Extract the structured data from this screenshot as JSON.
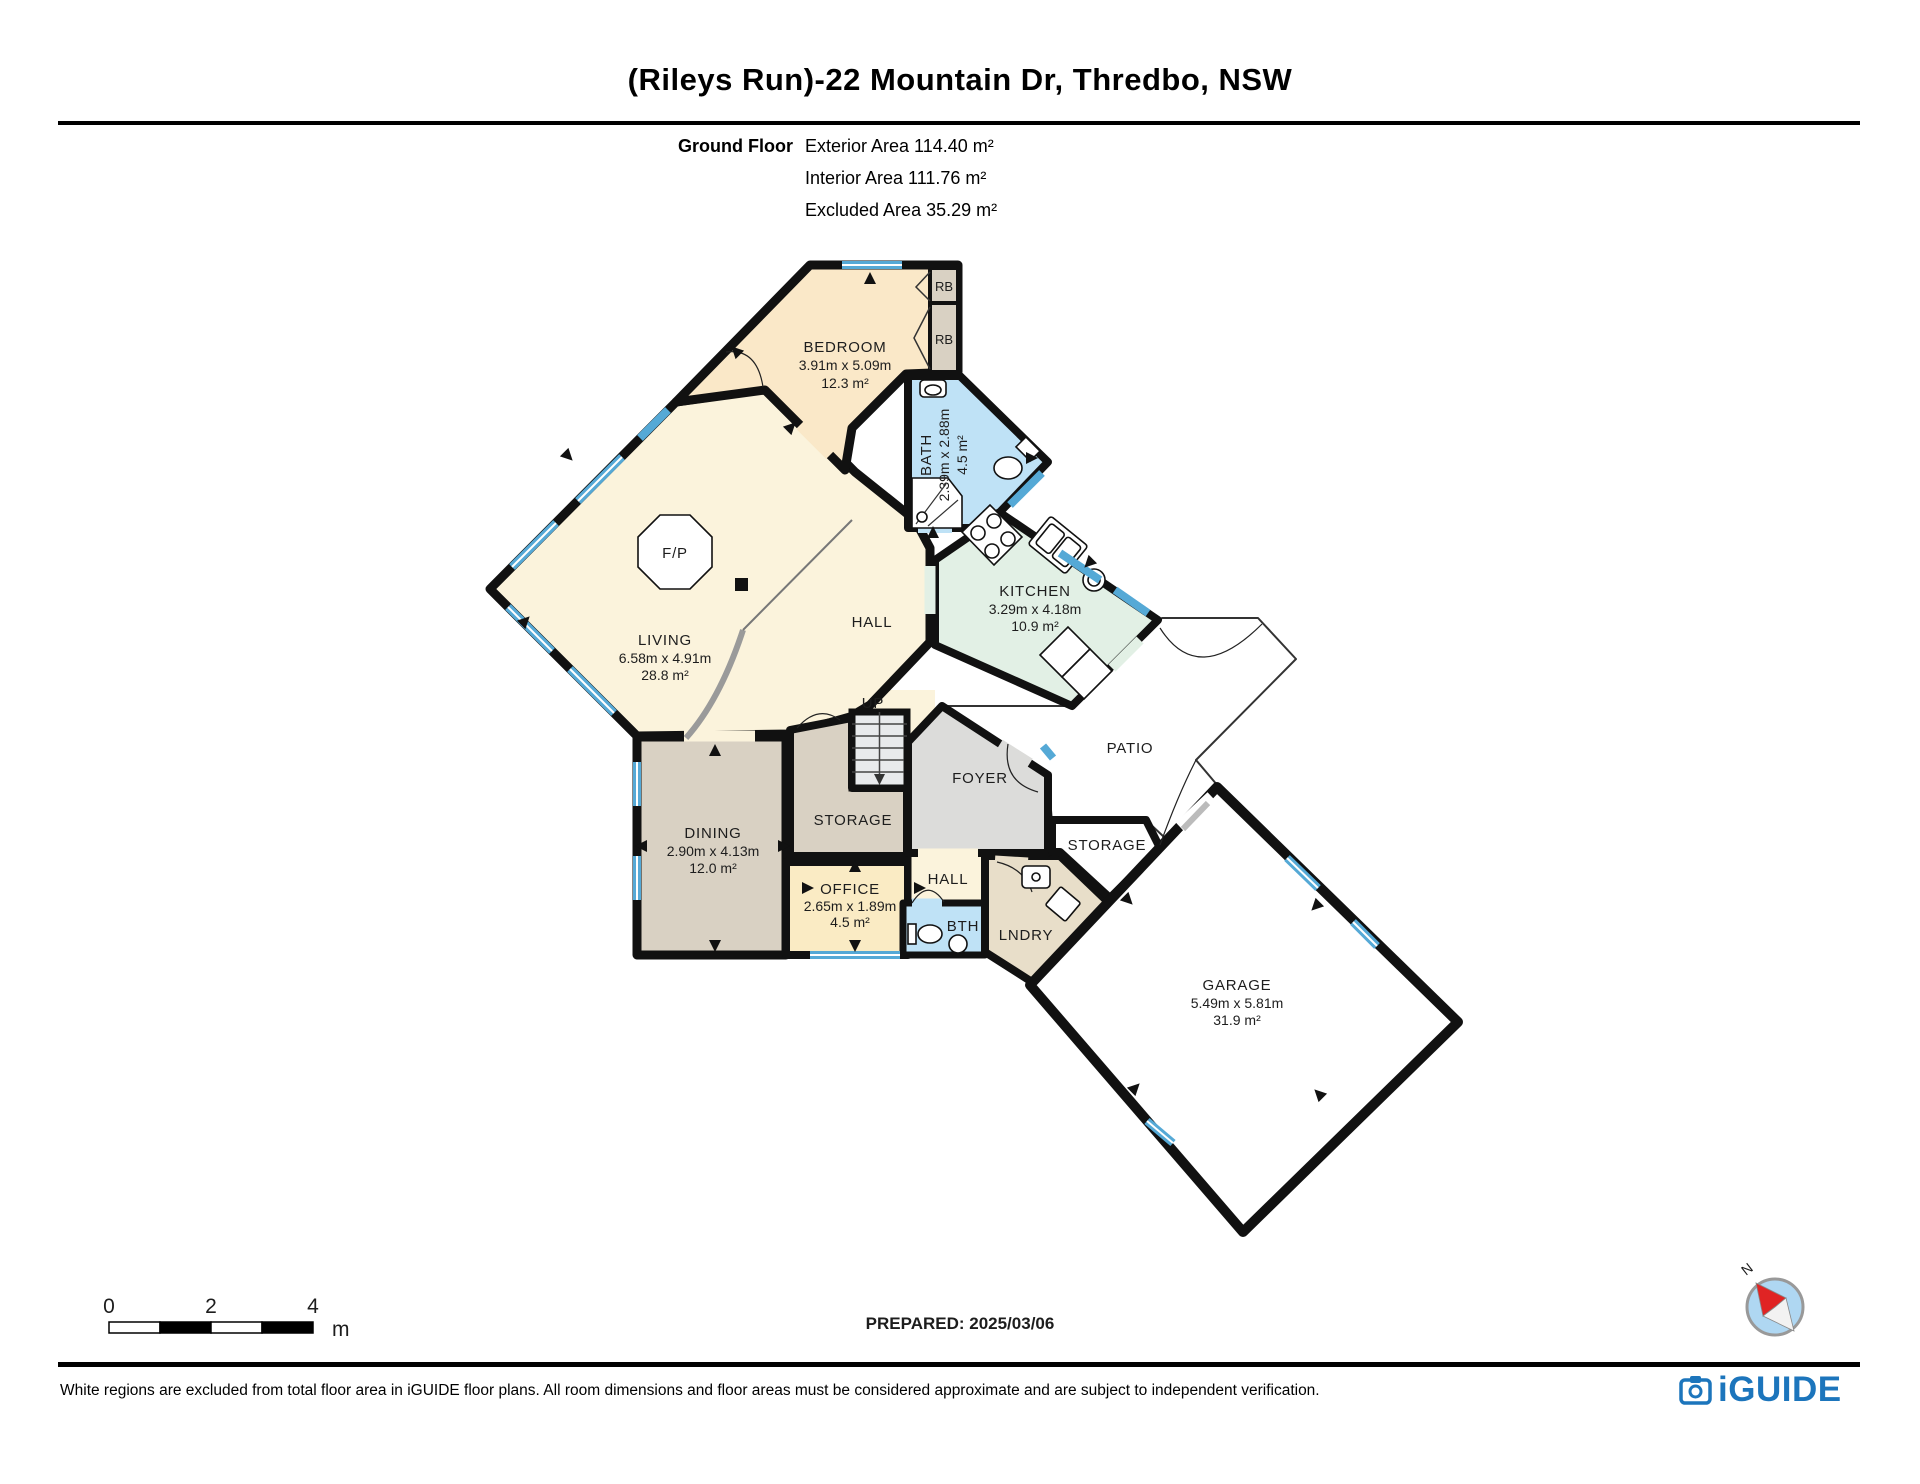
{
  "header": {
    "title": "(Rileys Run)-22 Mountain Dr, Thredbo, NSW",
    "floor_label": "Ground Floor",
    "areas": {
      "exterior": "Exterior Area 114.40 m²",
      "interior": "Interior Area 111.76 m²",
      "excluded": "Excluded Area 35.29 m²"
    }
  },
  "plan": {
    "rooms": {
      "bedroom": {
        "name": "BEDROOM",
        "dims": "3.91m x 5.09m",
        "area": "12.3 m²"
      },
      "bath": {
        "name": "BATH",
        "dims": "2.39m x 2.88m",
        "area": "4.5 m²"
      },
      "kitchen": {
        "name": "KITCHEN",
        "dims": "3.29m x 4.18m",
        "area": "10.9 m²"
      },
      "living": {
        "name": "LIVING",
        "dims": "6.58m x 4.91m",
        "area": "28.8 m²"
      },
      "dining": {
        "name": "DINING",
        "dims": "2.90m x 4.13m",
        "area": "12.0 m²"
      },
      "office": {
        "name": "OFFICE",
        "dims": "2.65m x 1.89m",
        "area": "4.5 m²"
      },
      "garage": {
        "name": "GARAGE",
        "dims": "5.49m x 5.81m",
        "area": "31.9 m²"
      },
      "hall_upper": {
        "name": "HALL"
      },
      "hall_lower": {
        "name": "HALL"
      },
      "storage_inner": {
        "name": "STORAGE"
      },
      "storage_outer": {
        "name": "STORAGE"
      },
      "foyer": {
        "name": "FOYER"
      },
      "patio": {
        "name": "PATIO"
      },
      "bth": {
        "name": "BTH"
      },
      "lndry": {
        "name": "LNDRY"
      },
      "up": {
        "name": "UP"
      },
      "fireplace": {
        "name": "F/P"
      },
      "robe1": {
        "name": "RB"
      },
      "robe2": {
        "name": "RB"
      }
    }
  },
  "scale_bar": {
    "ticks": [
      "0",
      "2",
      "4"
    ],
    "unit": "m"
  },
  "prepared_label": "PREPARED: 2025/03/06",
  "compass": {
    "north": "N"
  },
  "footer": {
    "disclaimer": "White regions are excluded from total floor area in iGUIDE floor plans. All room dimensions and floor areas must be considered approximate and are subject to independent verification.",
    "brand": "iGUIDE"
  },
  "colors": {
    "brand_blue": "#1C75BC",
    "window_blue": "#55A9D6",
    "bath_blue": "#BFE2F6",
    "kitchen_green": "#E2F0E5",
    "bedroom_tan": "#FAE8C8",
    "living_cream": "#FBF3DC",
    "dining_grey": "#D9D1C3",
    "foyer_grey": "#DCDCDA",
    "laundry_tan": "#E8DEC9"
  }
}
